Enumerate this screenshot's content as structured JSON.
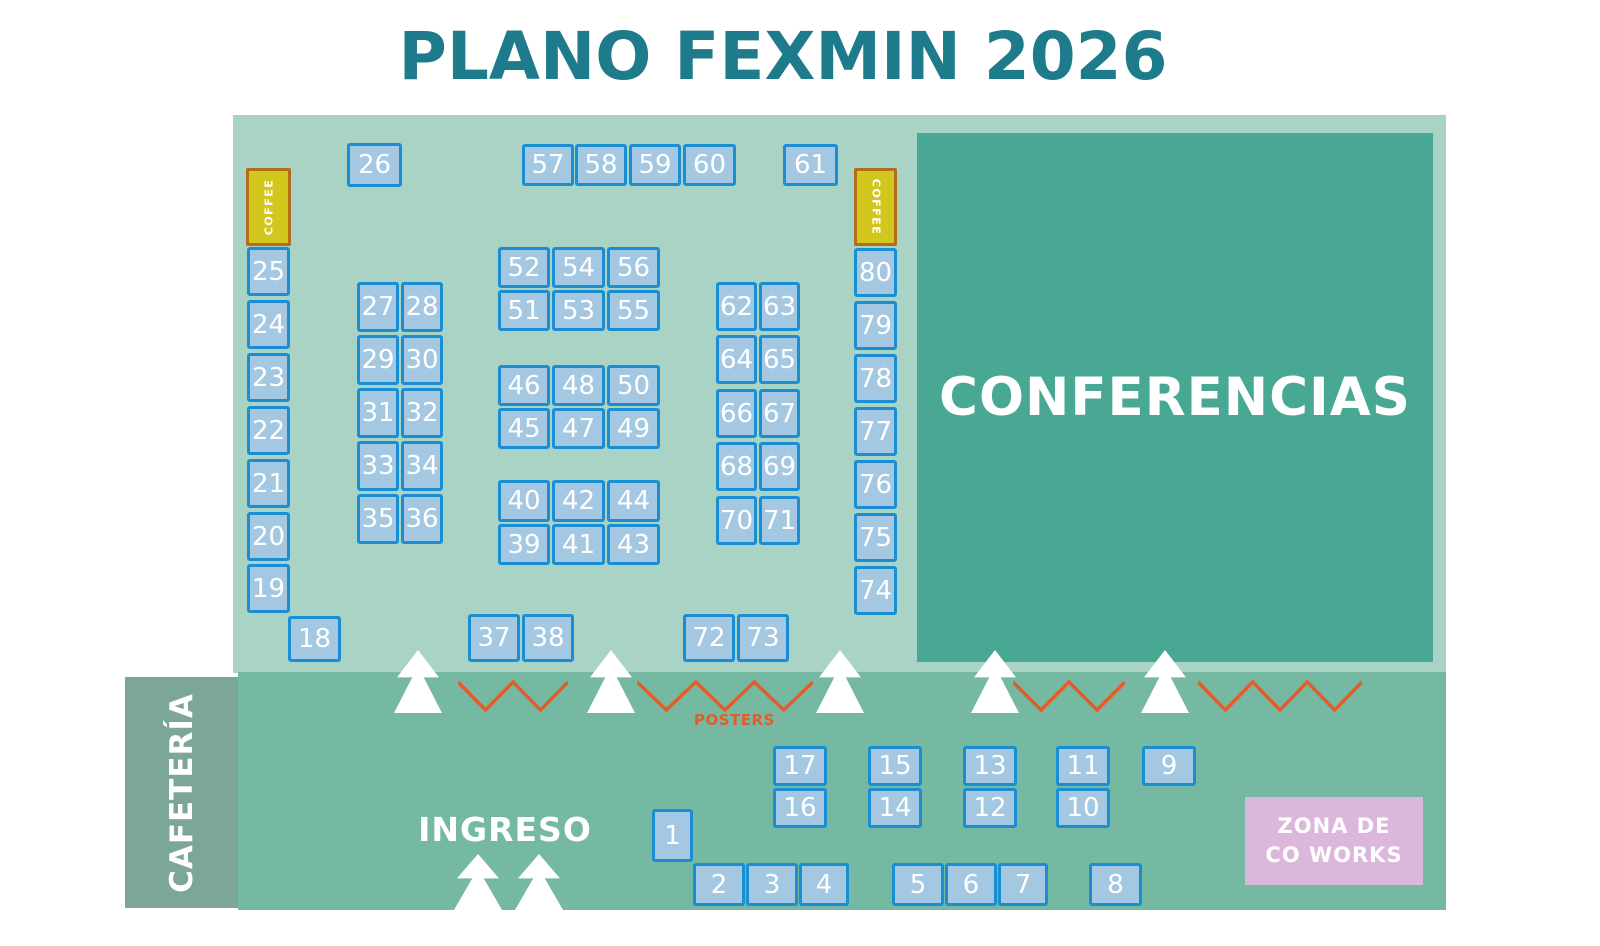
{
  "title": "PLANO FEXMIN 2026",
  "labels": {
    "conferences": "CONFERENCIAS",
    "cafeteria": "CAFETERÍA",
    "entrance": "INGRESO",
    "posters": "POSTERS",
    "coffee": "COFFEE",
    "cowork_line1": "ZONA DE",
    "cowork_line2": "CO WORKS"
  },
  "colors": {
    "title_teal": "#1e7b8c",
    "hall_mint": "#a9d3c5",
    "band_green": "#75b9a3",
    "conference_teal": "#48a894",
    "cafeteria_sage": "#7ca695",
    "booth_fill": "#a4c8e1",
    "booth_border": "#1a8ed3",
    "coffee_fill": "#d3c71e",
    "coffee_border": "#b16c1c",
    "accent_orange": "#e25d28",
    "cowork_pink": "#dcb7dc",
    "text_white": "#ffffff"
  },
  "booths": [
    {
      "id": "26",
      "x": 347,
      "y": 143,
      "w": 55,
      "h": 44
    },
    {
      "id": "57",
      "x": 522,
      "y": 144,
      "w": 52,
      "h": 42
    },
    {
      "id": "58",
      "x": 575,
      "y": 144,
      "w": 52,
      "h": 42
    },
    {
      "id": "59",
      "x": 629,
      "y": 144,
      "w": 52,
      "h": 42
    },
    {
      "id": "60",
      "x": 683,
      "y": 144,
      "w": 53,
      "h": 42
    },
    {
      "id": "61",
      "x": 783,
      "y": 144,
      "w": 55,
      "h": 42
    },
    {
      "id": "25",
      "x": 247,
      "y": 247,
      "w": 43,
      "h": 49
    },
    {
      "id": "24",
      "x": 247,
      "y": 300,
      "w": 43,
      "h": 49
    },
    {
      "id": "23",
      "x": 247,
      "y": 353,
      "w": 43,
      "h": 49
    },
    {
      "id": "22",
      "x": 247,
      "y": 406,
      "w": 43,
      "h": 49
    },
    {
      "id": "21",
      "x": 247,
      "y": 459,
      "w": 43,
      "h": 49
    },
    {
      "id": "20",
      "x": 247,
      "y": 512,
      "w": 43,
      "h": 49
    },
    {
      "id": "19",
      "x": 247,
      "y": 564,
      "w": 43,
      "h": 49
    },
    {
      "id": "18",
      "x": 288,
      "y": 616,
      "w": 53,
      "h": 46
    },
    {
      "id": "27",
      "x": 357,
      "y": 282,
      "w": 42,
      "h": 50
    },
    {
      "id": "28",
      "x": 401,
      "y": 282,
      "w": 42,
      "h": 50
    },
    {
      "id": "29",
      "x": 357,
      "y": 335,
      "w": 42,
      "h": 50
    },
    {
      "id": "30",
      "x": 401,
      "y": 335,
      "w": 42,
      "h": 50
    },
    {
      "id": "31",
      "x": 357,
      "y": 388,
      "w": 42,
      "h": 50
    },
    {
      "id": "32",
      "x": 401,
      "y": 388,
      "w": 42,
      "h": 50
    },
    {
      "id": "33",
      "x": 357,
      "y": 441,
      "w": 42,
      "h": 50
    },
    {
      "id": "34",
      "x": 401,
      "y": 441,
      "w": 42,
      "h": 50
    },
    {
      "id": "35",
      "x": 357,
      "y": 494,
      "w": 42,
      "h": 50
    },
    {
      "id": "36",
      "x": 401,
      "y": 494,
      "w": 42,
      "h": 50
    },
    {
      "id": "52",
      "x": 498,
      "y": 247,
      "w": 52,
      "h": 41
    },
    {
      "id": "54",
      "x": 552,
      "y": 247,
      "w": 53,
      "h": 41
    },
    {
      "id": "56",
      "x": 607,
      "y": 247,
      "w": 53,
      "h": 41
    },
    {
      "id": "51",
      "x": 498,
      "y": 290,
      "w": 52,
      "h": 41
    },
    {
      "id": "53",
      "x": 552,
      "y": 290,
      "w": 53,
      "h": 41
    },
    {
      "id": "55",
      "x": 607,
      "y": 290,
      "w": 53,
      "h": 41
    },
    {
      "id": "46",
      "x": 498,
      "y": 365,
      "w": 52,
      "h": 41
    },
    {
      "id": "48",
      "x": 552,
      "y": 365,
      "w": 53,
      "h": 41
    },
    {
      "id": "50",
      "x": 607,
      "y": 365,
      "w": 53,
      "h": 41
    },
    {
      "id": "45",
      "x": 498,
      "y": 408,
      "w": 52,
      "h": 41
    },
    {
      "id": "47",
      "x": 552,
      "y": 408,
      "w": 53,
      "h": 41
    },
    {
      "id": "49",
      "x": 607,
      "y": 408,
      "w": 53,
      "h": 41
    },
    {
      "id": "40",
      "x": 498,
      "y": 480,
      "w": 52,
      "h": 42
    },
    {
      "id": "42",
      "x": 552,
      "y": 480,
      "w": 53,
      "h": 42
    },
    {
      "id": "44",
      "x": 607,
      "y": 480,
      "w": 53,
      "h": 42
    },
    {
      "id": "39",
      "x": 498,
      "y": 524,
      "w": 52,
      "h": 41
    },
    {
      "id": "41",
      "x": 552,
      "y": 524,
      "w": 53,
      "h": 41
    },
    {
      "id": "43",
      "x": 607,
      "y": 524,
      "w": 53,
      "h": 41
    },
    {
      "id": "62",
      "x": 716,
      "y": 282,
      "w": 41,
      "h": 49
    },
    {
      "id": "63",
      "x": 759,
      "y": 282,
      "w": 41,
      "h": 49
    },
    {
      "id": "64",
      "x": 716,
      "y": 335,
      "w": 41,
      "h": 49
    },
    {
      "id": "65",
      "x": 759,
      "y": 335,
      "w": 41,
      "h": 49
    },
    {
      "id": "66",
      "x": 716,
      "y": 389,
      "w": 41,
      "h": 49
    },
    {
      "id": "67",
      "x": 759,
      "y": 389,
      "w": 41,
      "h": 49
    },
    {
      "id": "68",
      "x": 716,
      "y": 442,
      "w": 41,
      "h": 49
    },
    {
      "id": "69",
      "x": 759,
      "y": 442,
      "w": 41,
      "h": 49
    },
    {
      "id": "70",
      "x": 716,
      "y": 496,
      "w": 41,
      "h": 49
    },
    {
      "id": "71",
      "x": 759,
      "y": 496,
      "w": 41,
      "h": 49
    },
    {
      "id": "80",
      "x": 854,
      "y": 248,
      "w": 43,
      "h": 49
    },
    {
      "id": "79",
      "x": 854,
      "y": 301,
      "w": 43,
      "h": 49
    },
    {
      "id": "78",
      "x": 854,
      "y": 354,
      "w": 43,
      "h": 49
    },
    {
      "id": "77",
      "x": 854,
      "y": 407,
      "w": 43,
      "h": 49
    },
    {
      "id": "76",
      "x": 854,
      "y": 460,
      "w": 43,
      "h": 49
    },
    {
      "id": "75",
      "x": 854,
      "y": 513,
      "w": 43,
      "h": 49
    },
    {
      "id": "74",
      "x": 854,
      "y": 566,
      "w": 43,
      "h": 49
    },
    {
      "id": "37",
      "x": 468,
      "y": 614,
      "w": 52,
      "h": 48
    },
    {
      "id": "38",
      "x": 522,
      "y": 614,
      "w": 52,
      "h": 48
    },
    {
      "id": "72",
      "x": 683,
      "y": 614,
      "w": 52,
      "h": 48
    },
    {
      "id": "73",
      "x": 737,
      "y": 614,
      "w": 52,
      "h": 48
    },
    {
      "id": "17",
      "x": 773,
      "y": 746,
      "w": 54,
      "h": 40
    },
    {
      "id": "16",
      "x": 773,
      "y": 788,
      "w": 54,
      "h": 40
    },
    {
      "id": "15",
      "x": 868,
      "y": 746,
      "w": 54,
      "h": 40
    },
    {
      "id": "14",
      "x": 868,
      "y": 788,
      "w": 54,
      "h": 40
    },
    {
      "id": "13",
      "x": 963,
      "y": 746,
      "w": 54,
      "h": 40
    },
    {
      "id": "12",
      "x": 963,
      "y": 788,
      "w": 54,
      "h": 40
    },
    {
      "id": "11",
      "x": 1056,
      "y": 746,
      "w": 54,
      "h": 40
    },
    {
      "id": "10",
      "x": 1056,
      "y": 788,
      "w": 54,
      "h": 40
    },
    {
      "id": "9",
      "x": 1142,
      "y": 746,
      "w": 54,
      "h": 40
    },
    {
      "id": "1",
      "x": 652,
      "y": 809,
      "w": 41,
      "h": 53
    },
    {
      "id": "2",
      "x": 693,
      "y": 863,
      "w": 52,
      "h": 43
    },
    {
      "id": "3",
      "x": 746,
      "y": 863,
      "w": 52,
      "h": 43
    },
    {
      "id": "4",
      "x": 799,
      "y": 863,
      "w": 50,
      "h": 43
    },
    {
      "id": "5",
      "x": 892,
      "y": 863,
      "w": 52,
      "h": 43
    },
    {
      "id": "6",
      "x": 945,
      "y": 863,
      "w": 52,
      "h": 43
    },
    {
      "id": "7",
      "x": 998,
      "y": 863,
      "w": 50,
      "h": 43
    },
    {
      "id": "8",
      "x": 1089,
      "y": 863,
      "w": 53,
      "h": 43
    }
  ],
  "coffee_stations": [
    {
      "x": 246,
      "y": 168,
      "w": 45,
      "h": 78,
      "orientation": "left"
    },
    {
      "x": 854,
      "y": 168,
      "w": 43,
      "h": 78,
      "orientation": "right"
    }
  ],
  "decor": {
    "divider_arrows_cx": [
      418,
      611,
      840,
      995,
      1165
    ],
    "divider_arrows_y": 650,
    "entrance_arrows_cx": [
      478,
      539
    ],
    "entrance_arrows_y": 854,
    "zigzags": [
      {
        "x": 458,
        "w": 110,
        "vees": 2
      },
      {
        "x": 637,
        "w": 176,
        "vees": 3
      },
      {
        "x": 1013,
        "w": 112,
        "vees": 2
      },
      {
        "x": 1198,
        "w": 164,
        "vees": 3
      }
    ],
    "zigzag_y": 676
  }
}
